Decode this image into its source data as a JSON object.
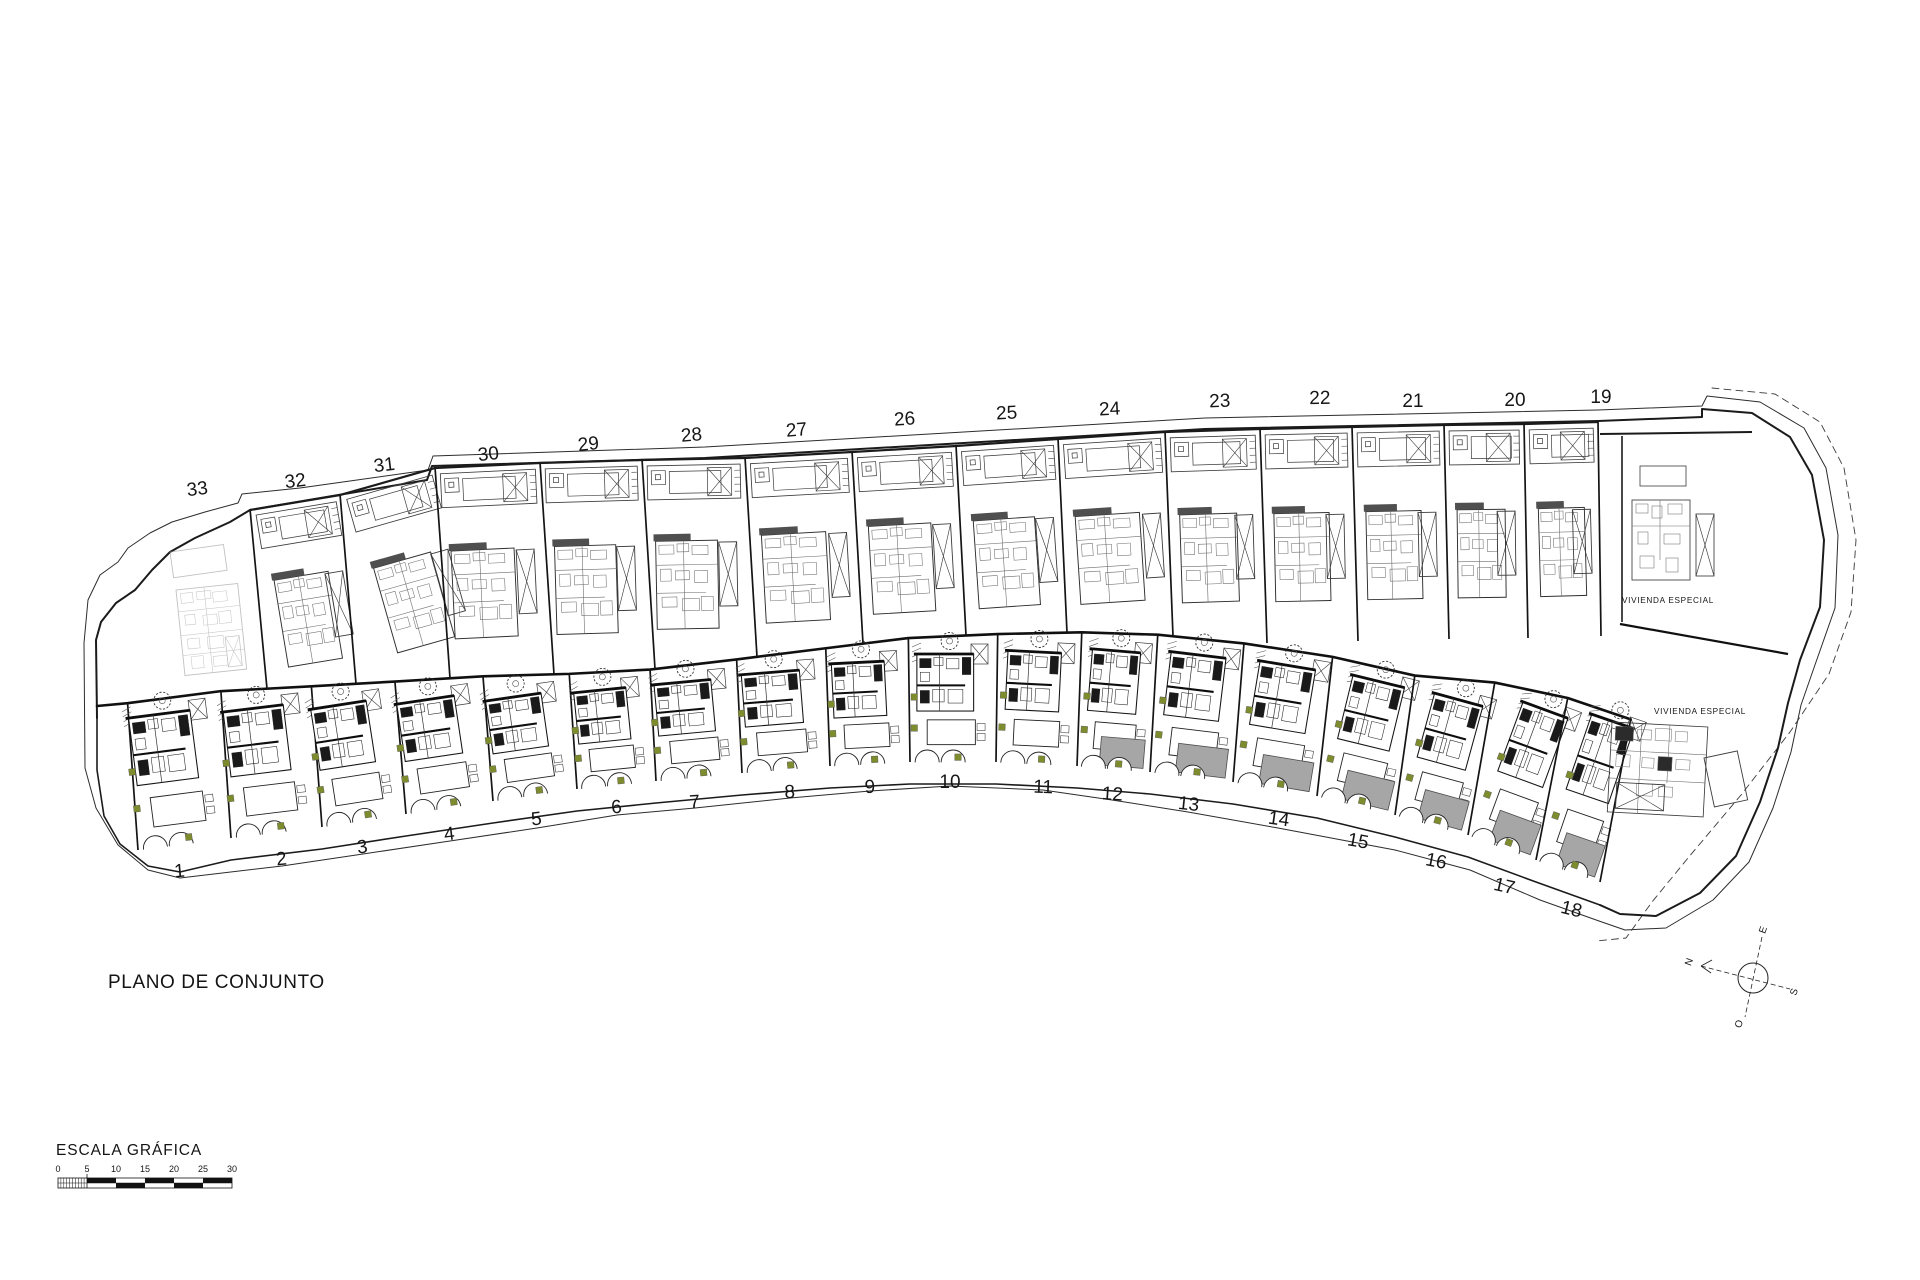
{
  "page": {
    "title": "PLANO DE CONJUNTO"
  },
  "scale": {
    "title": "ESCALA GRÁFICA",
    "ticks": [
      "0",
      "5",
      "10",
      "15",
      "20",
      "25",
      "30"
    ]
  },
  "compass": {
    "north": "N",
    "east": "E",
    "south": "S",
    "west": "O"
  },
  "special_parcels": [
    {
      "label": "VIVIENDA ESPECIAL"
    },
    {
      "label": "VIVIENDA ESPECIAL"
    }
  ],
  "upper_plots": [
    {
      "label": "33",
      "x": 198,
      "y": 495,
      "rot": -7
    },
    {
      "label": "32",
      "x": 296,
      "y": 487,
      "rot": -7
    },
    {
      "label": "31",
      "x": 385,
      "y": 471,
      "rot": -7
    },
    {
      "label": "30",
      "x": 489,
      "y": 460,
      "rot": -6
    },
    {
      "label": "29",
      "x": 589,
      "y": 450,
      "rot": -6
    },
    {
      "label": "28",
      "x": 692,
      "y": 441,
      "rot": -5
    },
    {
      "label": "27",
      "x": 797,
      "y": 436,
      "rot": -5
    },
    {
      "label": "26",
      "x": 905,
      "y": 425,
      "rot": -4
    },
    {
      "label": "25",
      "x": 1007,
      "y": 419,
      "rot": -3
    },
    {
      "label": "24",
      "x": 1110,
      "y": 415,
      "rot": -3
    },
    {
      "label": "23",
      "x": 1220,
      "y": 407,
      "rot": -2
    },
    {
      "label": "22",
      "x": 1320,
      "y": 404,
      "rot": -1
    },
    {
      "label": "21",
      "x": 1413,
      "y": 407,
      "rot": 0
    },
    {
      "label": "20",
      "x": 1515,
      "y": 406,
      "rot": 0
    },
    {
      "label": "19",
      "x": 1601,
      "y": 403,
      "rot": 0
    }
  ],
  "lower_plots": [
    {
      "label": "1",
      "x": 180,
      "y": 877,
      "rot": -5
    },
    {
      "label": "2",
      "x": 282,
      "y": 865,
      "rot": -6
    },
    {
      "label": "3",
      "x": 363,
      "y": 853,
      "rot": -7
    },
    {
      "label": "4",
      "x": 450,
      "y": 840,
      "rot": -7
    },
    {
      "label": "5",
      "x": 537,
      "y": 825,
      "rot": -6
    },
    {
      "label": "6",
      "x": 617,
      "y": 813,
      "rot": -5
    },
    {
      "label": "7",
      "x": 695,
      "y": 808,
      "rot": -4
    },
    {
      "label": "8",
      "x": 790,
      "y": 798,
      "rot": -3
    },
    {
      "label": "9",
      "x": 870,
      "y": 793,
      "rot": -2
    },
    {
      "label": "10",
      "x": 950,
      "y": 788,
      "rot": 0
    },
    {
      "label": "11",
      "x": 1043,
      "y": 793,
      "rot": 2
    },
    {
      "label": "12",
      "x": 1112,
      "y": 800,
      "rot": 4
    },
    {
      "label": "13",
      "x": 1188,
      "y": 810,
      "rot": 6
    },
    {
      "label": "14",
      "x": 1278,
      "y": 825,
      "rot": 8
    },
    {
      "label": "15",
      "x": 1357,
      "y": 847,
      "rot": 10
    },
    {
      "label": "16",
      "x": 1435,
      "y": 867,
      "rot": 11
    },
    {
      "label": "17",
      "x": 1503,
      "y": 892,
      "rot": 13
    },
    {
      "label": "18",
      "x": 1570,
      "y": 915,
      "rot": 14
    }
  ],
  "colors": {
    "ink": "#1b1b1b",
    "soft": "#3c3c3c",
    "light": "#6e6e6e",
    "faint": "#909090",
    "driveway_gray": "#a6a6a6",
    "marker_green": "#7e8c2e",
    "paper": "#ffffff"
  }
}
